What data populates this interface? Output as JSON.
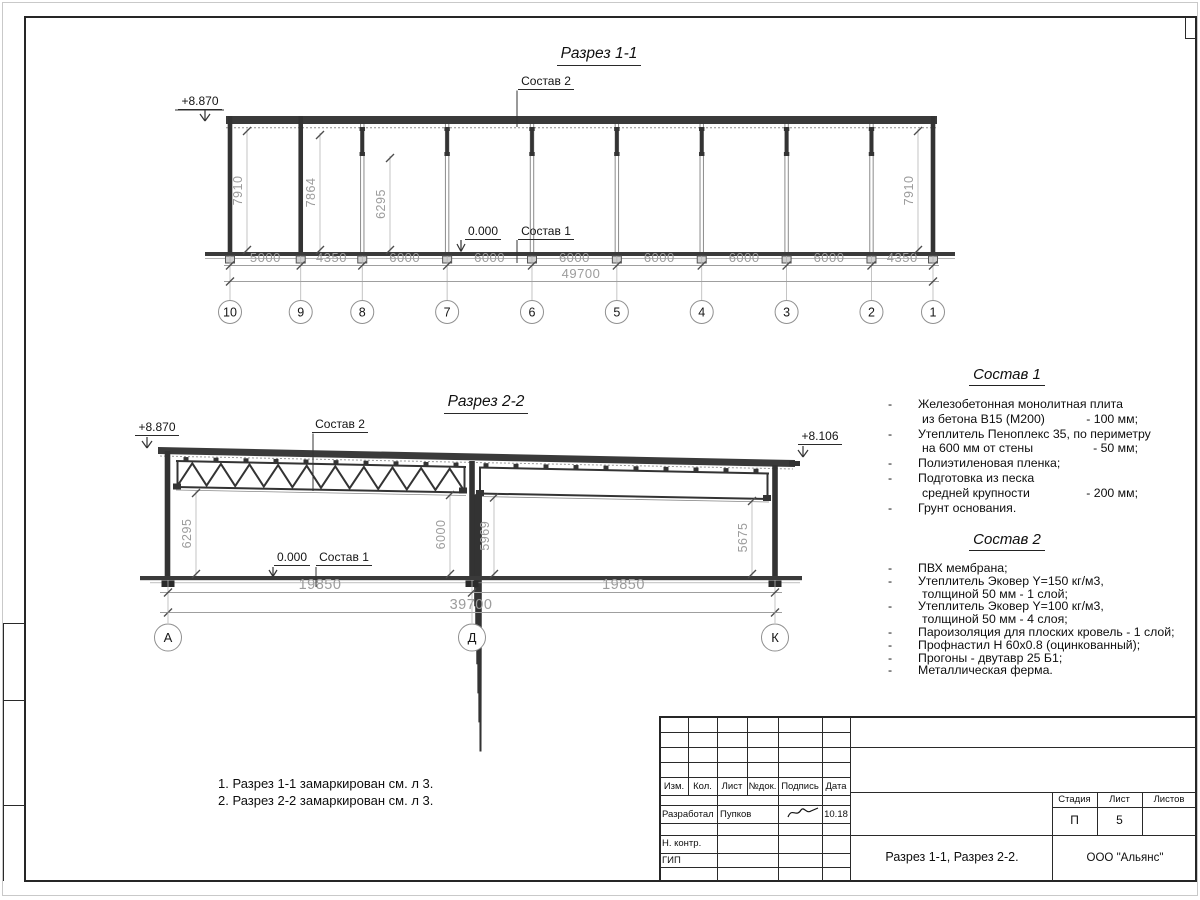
{
  "section1": {
    "title": "Разрез 1-1",
    "elev_left": "+8.870",
    "zero": "0.000",
    "label_sostav2": "Состав 2",
    "label_sostav1": "Состав 1",
    "dims_axes": [
      "5000",
      "4350",
      "6000",
      "6000",
      "6000",
      "6000",
      "6000",
      "6000",
      "4350"
    ],
    "dim_total": "49700",
    "dims_vert": [
      "7910",
      "7864",
      "6295",
      "7910"
    ],
    "axes": [
      "10",
      "9",
      "8",
      "7",
      "6",
      "5",
      "4",
      "3",
      "2",
      "1"
    ]
  },
  "section2": {
    "title": "Разрез 2-2",
    "elev_left": "+8.870",
    "elev_right": "+8.106",
    "zero": "0.000",
    "label_sostav2": "Состав 2",
    "label_sostav1": "Состав 1",
    "dims_vert": [
      "6295",
      "6000",
      "5969",
      "5675"
    ],
    "dims_span": [
      "19850",
      "19850"
    ],
    "dim_total": "39700",
    "axes": [
      "А",
      "Д",
      "К"
    ]
  },
  "sostav1": {
    "title": "Состав 1",
    "rows": [
      {
        "dash": "-",
        "text": "Железобетонная  монолитная плита",
        "value": ""
      },
      {
        "dash": "",
        "text": "из бетона В15 (М200)",
        "value": "- 100 мм;"
      },
      {
        "dash": "-",
        "text": "Утеплитель Пеноплекс 35, по периметру",
        "value": ""
      },
      {
        "dash": "",
        "text": "на 600 мм от стены",
        "value": "- 50 мм;"
      },
      {
        "dash": "-",
        "text": "Полиэтиленовая пленка;",
        "value": ""
      },
      {
        "dash": "-",
        "text": "Подготовка из песка",
        "value": ""
      },
      {
        "dash": "",
        "text": "средней крупности",
        "value": "- 200 мм;"
      },
      {
        "dash": "-",
        "text": "Грунт основания.",
        "value": ""
      }
    ]
  },
  "sostav2": {
    "title": "Состав 2",
    "rows": [
      {
        "dash": "-",
        "text": "ПВХ мембрана;",
        "value": ""
      },
      {
        "dash": "-",
        "text": "Утеплитель Эковер Y=150 кг/м3,",
        "value": ""
      },
      {
        "dash": "",
        "text": "толщиной 50 мм - 1 слой;",
        "value": ""
      },
      {
        "dash": "-",
        "text": "Утеплитель Эковер Y=100 кг/м3,",
        "value": ""
      },
      {
        "dash": "",
        "text": "толщиной 50 мм - 4 слоя;",
        "value": ""
      },
      {
        "dash": "-",
        "text": "Пароизоляция для плоских кровель - 1 слой;",
        "value": ""
      },
      {
        "dash": "-",
        "text": "Профнастил Н 60х0.8 (оцинкованный);",
        "value": ""
      },
      {
        "dash": "-",
        "text": "Прогоны - двутавр 25 Б1;",
        "value": ""
      },
      {
        "dash": "-",
        "text": "Металлическая ферма.",
        "value": ""
      }
    ]
  },
  "notes": [
    "1. Разрез 1-1 замаркирован см. л 3.",
    "2. Разрез 2-2 замаркирован см. л 3."
  ],
  "titleblock": {
    "cols": [
      "Изм.",
      "Кол.",
      "Лист",
      "№док.",
      "Подпись",
      "Дата"
    ],
    "rows": [
      {
        "role": "Разработал",
        "name": "Пупков",
        "date": "10.18"
      },
      {
        "role": "Н. контр.",
        "name": "",
        "date": ""
      },
      {
        "role": "ГИП",
        "name": "",
        "date": ""
      }
    ],
    "stage_cols": [
      "Стадия",
      "Лист",
      "Листов"
    ],
    "stage": "П",
    "sheet": "5",
    "sheets": "",
    "doc_title": "Разрез 1-1, Разрез 2-2.",
    "company": "ООО \"Альянс\""
  }
}
